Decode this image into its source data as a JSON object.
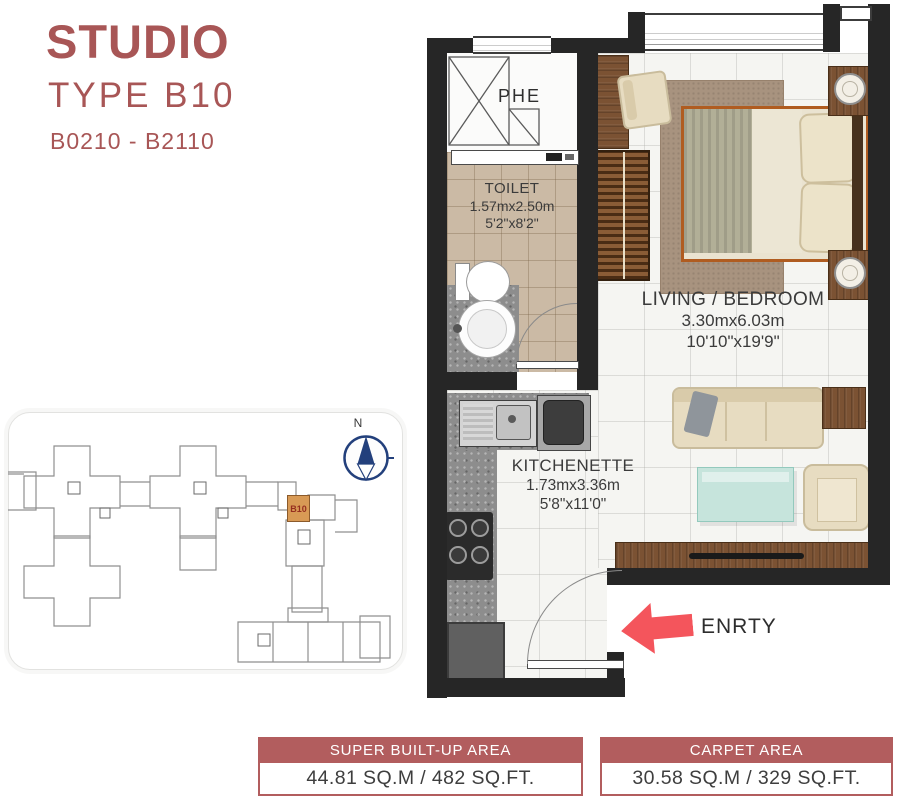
{
  "title": {
    "name": "STUDIO",
    "type": "TYPE B10",
    "units": "B0210 - B2110"
  },
  "floor_plan": {
    "rooms": {
      "phe": {
        "label": "PHE"
      },
      "toilet": {
        "label": "TOILET",
        "dim_m": "1.57mx2.50m",
        "dim_ft": "5'2\"x8'2\""
      },
      "living_bedroom": {
        "label": "LIVING / BEDROOM",
        "dim_m": "3.30mx6.03m",
        "dim_ft": "10'10\"x19'9\""
      },
      "kitchenette": {
        "label": "KITCHENETTE",
        "dim_m": "1.73mx3.36m",
        "dim_ft": "5'8\"x11'0\""
      }
    },
    "entry_label": "ENRTY"
  },
  "key_plan": {
    "unit_label": "B10",
    "compass_label": "N"
  },
  "area_info": [
    {
      "label": "SUPER BUILT-UP AREA",
      "value": "44.81 SQ.M / 482 SQ.FT."
    },
    {
      "label": "CARPET AREA",
      "value": "30.58 SQ.M / 329 SQ.FT."
    }
  ],
  "colors": {
    "accent_red": "#b25d5e",
    "title_red": "#a85656",
    "entry_arrow": "#f4555c",
    "keyplan_orange": "#d89a55",
    "compass_navy": "#23407c",
    "wall_dark": "#262626"
  }
}
